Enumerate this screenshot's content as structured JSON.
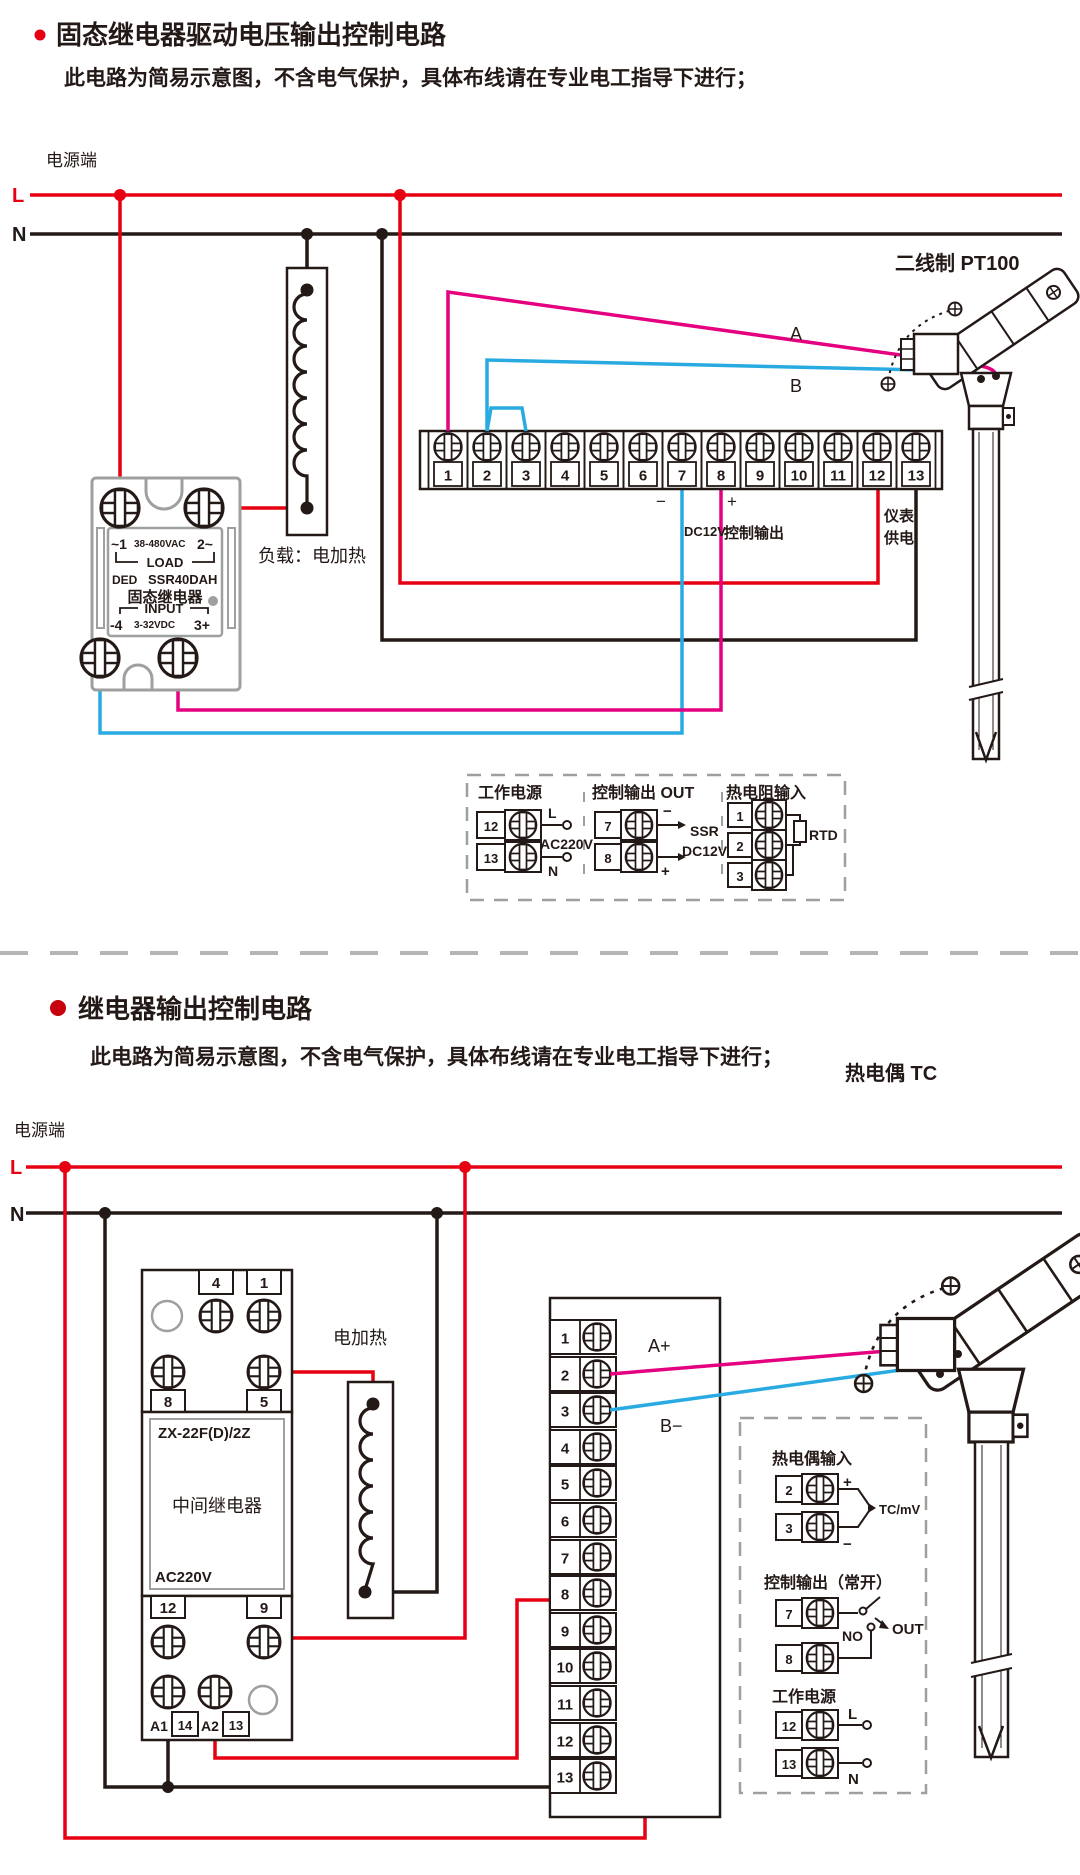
{
  "colors": {
    "live_red": "#e60012",
    "signal_magenta": "#e4007f",
    "signal_blue": "#29abe2",
    "ink": "#231916",
    "outline_gray": "#9e9f9f"
  },
  "s1": {
    "title": "固态继电器驱动电压输出控制电路",
    "subtitle": "此电路为简易示意图，不含电气保护，具体布线请在专业电工指导下进行；",
    "power_label": "电源端",
    "l": "L",
    "n": "N",
    "load_label": "负载：电加热",
    "ssr": {
      "t1": "~1",
      "volt": "38-480VAC",
      "t2": "2~",
      "load": "LOAD",
      "brand": "DED",
      "model": "SSR40DAH",
      "name": "固态继电器",
      "input": "INPUT",
      "in_l": "-4",
      "in_volt": "3-32VDC",
      "in_r": "3+"
    },
    "terminals": [
      "1",
      "2",
      "3",
      "4",
      "5",
      "6",
      "7",
      "8",
      "9",
      "10",
      "11",
      "12",
      "13"
    ],
    "minus": "−",
    "plus": "+",
    "dc12v": "DC12V",
    "ctrl": "控制输出",
    "meter1": "仪表",
    "meter2": "供电",
    "wire_a": "A",
    "wire_b": "B",
    "sensor": "二线制 PT100",
    "legend": {
      "power": {
        "title": "工作电源",
        "r1": "12",
        "r2": "13",
        "l": "L",
        "n": "N",
        "volt": "AC220V"
      },
      "out": {
        "title": "控制输出 OUT",
        "r1": "7",
        "r2": "8",
        "minus": "−",
        "plus": "+",
        "ssr": "SSR",
        "dc12v": "DC12V"
      },
      "rtd": {
        "title": "热电阻输入",
        "r1": "1",
        "r2": "2",
        "r3": "3",
        "rtd": "RTD"
      }
    }
  },
  "s2": {
    "title": "继电器输出控制电路",
    "subtitle": "此电路为简易示意图，不含电气保护，具体布线请在专业电工指导下进行；",
    "power_label": "电源端",
    "l": "L",
    "n": "N",
    "heater": "电加热",
    "relay": {
      "t4": "4",
      "t1": "1",
      "t8": "8",
      "t5": "5",
      "model": "ZX-22F(D)/2Z",
      "name": "中间继电器",
      "volt": "AC220V",
      "t12": "12",
      "t9": "9",
      "a1": "A1",
      "n14": "14",
      "a2": "A2",
      "n13": "13"
    },
    "terminals": [
      "1",
      "2",
      "3",
      "4",
      "5",
      "6",
      "7",
      "8",
      "9",
      "10",
      "11",
      "12",
      "13"
    ],
    "wire_a": "A+",
    "wire_b": "B−",
    "sensor": "热电偶 TC",
    "legend": {
      "tc": {
        "title": "热电偶输入",
        "r1": "2",
        "r2": "3",
        "plus": "+",
        "minus": "−",
        "sig": "TC/mV"
      },
      "out": {
        "title": "控制输出（常开）",
        "r1": "7",
        "r2": "8",
        "no": "NO",
        "out": "OUT"
      },
      "power": {
        "title": "工作电源",
        "r1": "12",
        "r2": "13",
        "l": "L",
        "n": "N"
      }
    }
  }
}
